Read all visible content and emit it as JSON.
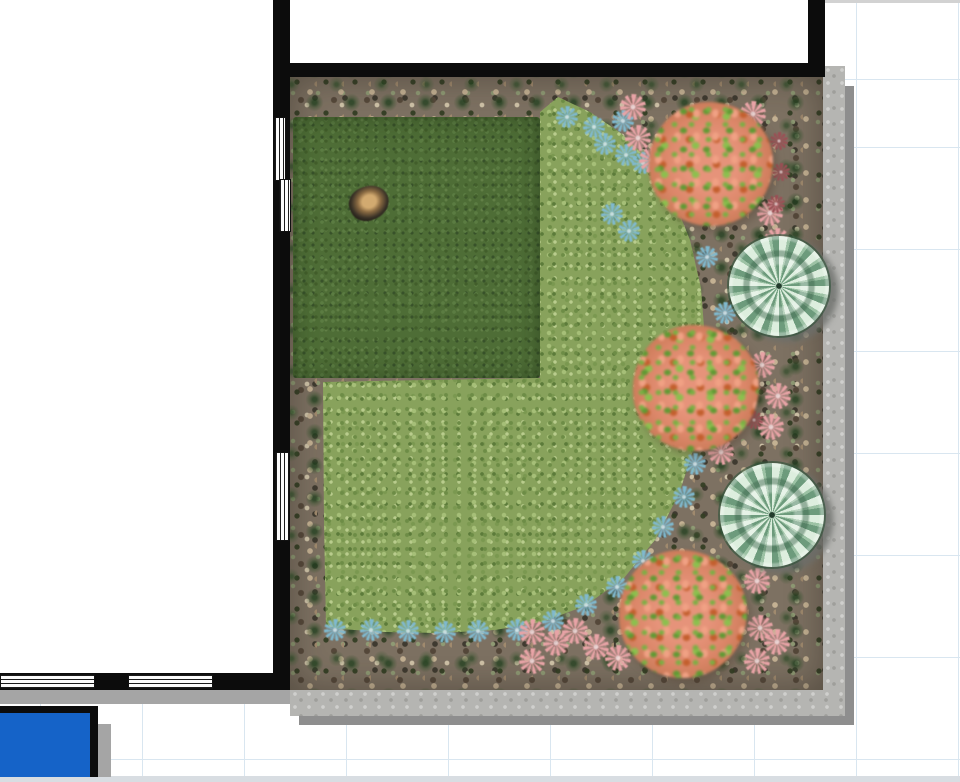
{
  "app": {
    "view": "garden-plan-canvas"
  },
  "canvas": {
    "width": 960,
    "height": 782,
    "background": "#ffffff",
    "grid": {
      "spacing": 102,
      "offset_x": 40,
      "offset_y": 80,
      "line_color": "#d9e6f0"
    },
    "edge_top_color": "#d2d2d2",
    "edge_bottom_color": "#d8dde2"
  },
  "palette": {
    "wall": "#0c0c0c",
    "gravel": "#7d7162",
    "lawn": "#4e6d36",
    "groundcover": "#88a25c",
    "bush_pink": "#e6937a",
    "bush_green": "#79b043",
    "cactus": "#9cc2a4",
    "flower_blue": "#7fb9cf",
    "flower_pink": "#e8a3a6",
    "flower_maroon": "#9c4f55",
    "border_paving": "#b5b5b2",
    "shadow": "#8e8e8e",
    "pool_blue": "#1563c8"
  },
  "structure": {
    "interior_floor": [
      {
        "x": 0,
        "y": 0,
        "w": 273,
        "h": 673
      },
      {
        "x": 273,
        "y": 0,
        "w": 535,
        "h": 63
      }
    ],
    "walls": [
      {
        "id": "left-wall",
        "x": 273,
        "y": 0,
        "w": 17,
        "h": 690
      },
      {
        "id": "top-wall",
        "x": 273,
        "y": 63,
        "w": 552,
        "h": 14
      },
      {
        "id": "top-right-wall",
        "x": 808,
        "y": 0,
        "w": 17,
        "h": 77
      },
      {
        "id": "bottom-wall",
        "x": 0,
        "y": 673,
        "w": 290,
        "h": 17
      }
    ],
    "windows": [
      {
        "id": "window-left-upper-a",
        "x": 274,
        "y": 117,
        "w": 12,
        "h": 64,
        "dir": "v"
      },
      {
        "id": "window-left-upper-b",
        "x": 279,
        "y": 179,
        "w": 12,
        "h": 53,
        "dir": "v"
      },
      {
        "id": "window-left-lower",
        "x": 275,
        "y": 452,
        "w": 14,
        "h": 89,
        "dir": "v"
      },
      {
        "id": "window-bottom-left",
        "x": 0,
        "y": 674,
        "w": 95,
        "h": 15,
        "dir": "h"
      },
      {
        "id": "window-bottom-mid",
        "x": 128,
        "y": 674,
        "w": 85,
        "h": 15,
        "dir": "h"
      }
    ],
    "wall_shadow": {
      "x": 0,
      "y": 690,
      "w": 290,
      "h": 14
    }
  },
  "garden": {
    "bed": {
      "x": 290,
      "y": 77,
      "w": 533,
      "h": 613
    },
    "border": {
      "right": {
        "x": 823,
        "y": 66,
        "w": 22,
        "h": 650
      },
      "bottom": {
        "x": 290,
        "y": 690,
        "w": 555,
        "h": 26
      },
      "shadow_right": {
        "x": 845,
        "y": 86,
        "w": 9,
        "h": 639
      },
      "shadow_bottom": {
        "x": 299,
        "y": 716,
        "w": 555,
        "h": 9
      }
    },
    "lawn": {
      "x": 293,
      "y": 117,
      "w": 247,
      "h": 261
    },
    "rock": {
      "cx": 369,
      "cy": 203,
      "w": 40,
      "h": 34,
      "rotation": -24
    },
    "groundcover_polygon": [
      [
        540,
        112
      ],
      [
        558,
        97
      ],
      [
        590,
        112
      ],
      [
        622,
        134
      ],
      [
        650,
        162
      ],
      [
        673,
        198
      ],
      [
        690,
        240
      ],
      [
        701,
        288
      ],
      [
        705,
        340
      ],
      [
        703,
        392
      ],
      [
        695,
        444
      ],
      [
        679,
        494
      ],
      [
        655,
        540
      ],
      [
        624,
        578
      ],
      [
        585,
        606
      ],
      [
        542,
        622
      ],
      [
        495,
        630
      ],
      [
        440,
        633
      ],
      [
        385,
        632
      ],
      [
        340,
        629
      ],
      [
        326,
        626
      ],
      [
        324,
        520
      ],
      [
        323,
        382
      ],
      [
        540,
        378
      ]
    ],
    "bushes": [
      {
        "id": "bush-top",
        "cx": 711,
        "cy": 164,
        "r": 62
      },
      {
        "id": "bush-middle",
        "cx": 696,
        "cy": 388,
        "r": 63
      },
      {
        "id": "bush-bottom",
        "cx": 683,
        "cy": 614,
        "r": 64
      }
    ],
    "cacti": [
      {
        "id": "cactus-upper",
        "cx": 779,
        "cy": 286,
        "r": 50
      },
      {
        "id": "cactus-lower",
        "cx": 772,
        "cy": 515,
        "r": 52
      }
    ],
    "flowers": {
      "blue": [
        [
          567,
          117
        ],
        [
          594,
          127
        ],
        [
          605,
          144
        ],
        [
          623,
          121
        ],
        [
          626,
          155
        ],
        [
          643,
          163
        ],
        [
          612,
          214
        ],
        [
          629,
          231
        ],
        [
          707,
          257
        ],
        [
          725,
          313
        ],
        [
          695,
          464
        ],
        [
          684,
          497
        ],
        [
          663,
          527
        ],
        [
          643,
          561
        ],
        [
          617,
          587
        ],
        [
          586,
          605
        ],
        [
          553,
          621
        ],
        [
          335,
          630
        ],
        [
          371,
          630
        ],
        [
          408,
          631
        ],
        [
          445,
          632
        ],
        [
          478,
          631
        ],
        [
          517,
          630
        ]
      ],
      "pink": [
        [
          633,
          107
        ],
        [
          638,
          138
        ],
        [
          652,
          160
        ],
        [
          753,
          114
        ],
        [
          770,
          213
        ],
        [
          777,
          241
        ],
        [
          762,
          365
        ],
        [
          778,
          396
        ],
        [
          771,
          427
        ],
        [
          721,
          452
        ],
        [
          718,
          579
        ],
        [
          757,
          581
        ],
        [
          760,
          628
        ],
        [
          777,
          642
        ],
        [
          757,
          661
        ],
        [
          532,
          632
        ],
        [
          556,
          643
        ],
        [
          532,
          661
        ],
        [
          575,
          631
        ],
        [
          596,
          647
        ],
        [
          618,
          658
        ]
      ],
      "maroon": [
        [
          779,
          141
        ],
        [
          781,
          172
        ],
        [
          776,
          204
        ],
        [
          754,
          420
        ]
      ]
    }
  },
  "pool": {
    "x": 0,
    "y": 706,
    "w": 98,
    "h": 71,
    "border_top": 7,
    "border_right": 8,
    "fill": "#1563c8",
    "border_color": "#0c0c0c",
    "shadow": {
      "x": 98,
      "y": 724,
      "w": 13,
      "h": 53
    }
  }
}
